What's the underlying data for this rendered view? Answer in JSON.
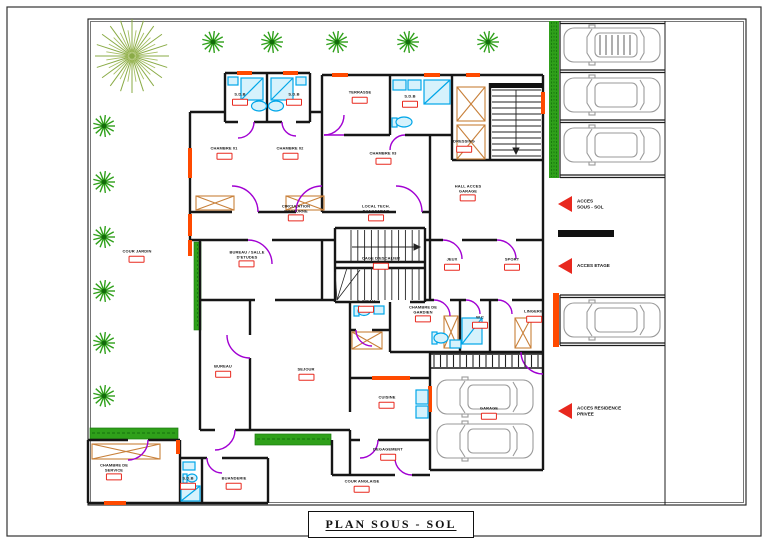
{
  "title": {
    "text": "PLAN  SOUS - SOL"
  },
  "rooms": [
    {
      "id": "terrasse",
      "l1": "TERRASSE",
      "l2": "",
      "x": 360,
      "y": 97
    },
    {
      "id": "sdb-a",
      "l1": "S.D.B",
      "l2": "",
      "x": 240,
      "y": 99
    },
    {
      "id": "sdb-b",
      "l1": "S.D.B",
      "l2": "",
      "x": 294,
      "y": 99
    },
    {
      "id": "sdb-c",
      "l1": "S.D.B",
      "l2": "",
      "x": 410,
      "y": 101
    },
    {
      "id": "chambre-01",
      "l1": "CHAMBRE 01",
      "l2": "",
      "x": 224,
      "y": 153
    },
    {
      "id": "chambre-02",
      "l1": "CHAMBRE 02",
      "l2": "",
      "x": 290,
      "y": 153
    },
    {
      "id": "chambre-03",
      "l1": "CHAMBRE 03",
      "l2": "",
      "x": 383,
      "y": 158
    },
    {
      "id": "dressing",
      "l1": "DRESSING",
      "l2": "",
      "x": 464,
      "y": 146
    },
    {
      "id": "hall-acces-garage",
      "l1": "HALL ACCES",
      "l2": "GARAGE",
      "x": 468,
      "y": 193
    },
    {
      "id": "circulation-nocturne",
      "l1": "CIRCULATION",
      "l2": "NOCTURNE",
      "x": 296,
      "y": 213
    },
    {
      "id": "local-rangement",
      "l1": "LOCAL TECH.",
      "l2": "RANGEMENT",
      "x": 376,
      "y": 213
    },
    {
      "id": "cour-jardin",
      "l1": "COUR  JARDIN",
      "l2": "",
      "x": 137,
      "y": 256
    },
    {
      "id": "bureau-salle-etudes",
      "l1": "BUREAU / SALLE",
      "l2": "D'ETUDES",
      "x": 247,
      "y": 259
    },
    {
      "id": "cage-escalier",
      "l1": "CAGE D'ESCALIER",
      "l2": "",
      "x": 381,
      "y": 263
    },
    {
      "id": "jeux",
      "l1": "JEUX",
      "l2": "",
      "x": 452,
      "y": 264
    },
    {
      "id": "sport",
      "l1": "SPORT",
      "l2": "",
      "x": 512,
      "y": 264
    },
    {
      "id": "salle-deau",
      "l1": "S. D'EAU",
      "l2": "",
      "x": 366,
      "y": 306
    },
    {
      "id": "chambre-gardien",
      "l1": "CHAMBRE DE",
      "l2": "GARDIEN",
      "x": 423,
      "y": 314
    },
    {
      "id": "wc",
      "l1": "W.C",
      "l2": "",
      "x": 480,
      "y": 322
    },
    {
      "id": "lingerie",
      "l1": "LINGERIE",
      "l2": "",
      "x": 534,
      "y": 316
    },
    {
      "id": "bureau",
      "l1": "BUREAU",
      "l2": "",
      "x": 223,
      "y": 371
    },
    {
      "id": "sejour",
      "l1": "SEJOUR",
      "l2": "",
      "x": 306,
      "y": 374
    },
    {
      "id": "cuisine",
      "l1": "CUISINE",
      "l2": "",
      "x": 387,
      "y": 402
    },
    {
      "id": "garage",
      "l1": "GARAGE",
      "l2": "",
      "x": 489,
      "y": 413
    },
    {
      "id": "degagement",
      "l1": "DEGAGEMENT",
      "l2": "",
      "x": 388,
      "y": 454
    },
    {
      "id": "cour-anglaise",
      "l1": "COUR ANGLAISE",
      "l2": "",
      "x": 362,
      "y": 486
    },
    {
      "id": "chambre-service",
      "l1": "CHAMBRE DE",
      "l2": "SERVICE",
      "x": 114,
      "y": 472
    },
    {
      "id": "sdb-d",
      "l1": "S.D.B",
      "l2": "",
      "x": 188,
      "y": 483
    },
    {
      "id": "buanderie",
      "l1": "BUANDERIE",
      "l2": "",
      "x": 234,
      "y": 483
    }
  ],
  "access": [
    {
      "id": "acces-sous-sol",
      "l1": "ACCES",
      "l2": "SOUS - SOL",
      "x": 577,
      "y": 204
    },
    {
      "id": "acces-etage",
      "l1": "ACCES ETAGE",
      "l2": "",
      "x": 577,
      "y": 266
    },
    {
      "id": "acces-residence-privee",
      "l1": "ACCES RESIDENCE",
      "l2": "PRIVEE",
      "x": 577,
      "y": 411
    }
  ],
  "colors": {
    "wall": "#161616",
    "door_arc": "#a100d2",
    "threshold": "#ff4a00",
    "fixture": "#00a6e8",
    "closet": "#c8803a",
    "shrub": "#2fa01a",
    "big_tree": "#8aab46",
    "car": "#9a9a9a",
    "accent_red": "#e8281e"
  }
}
